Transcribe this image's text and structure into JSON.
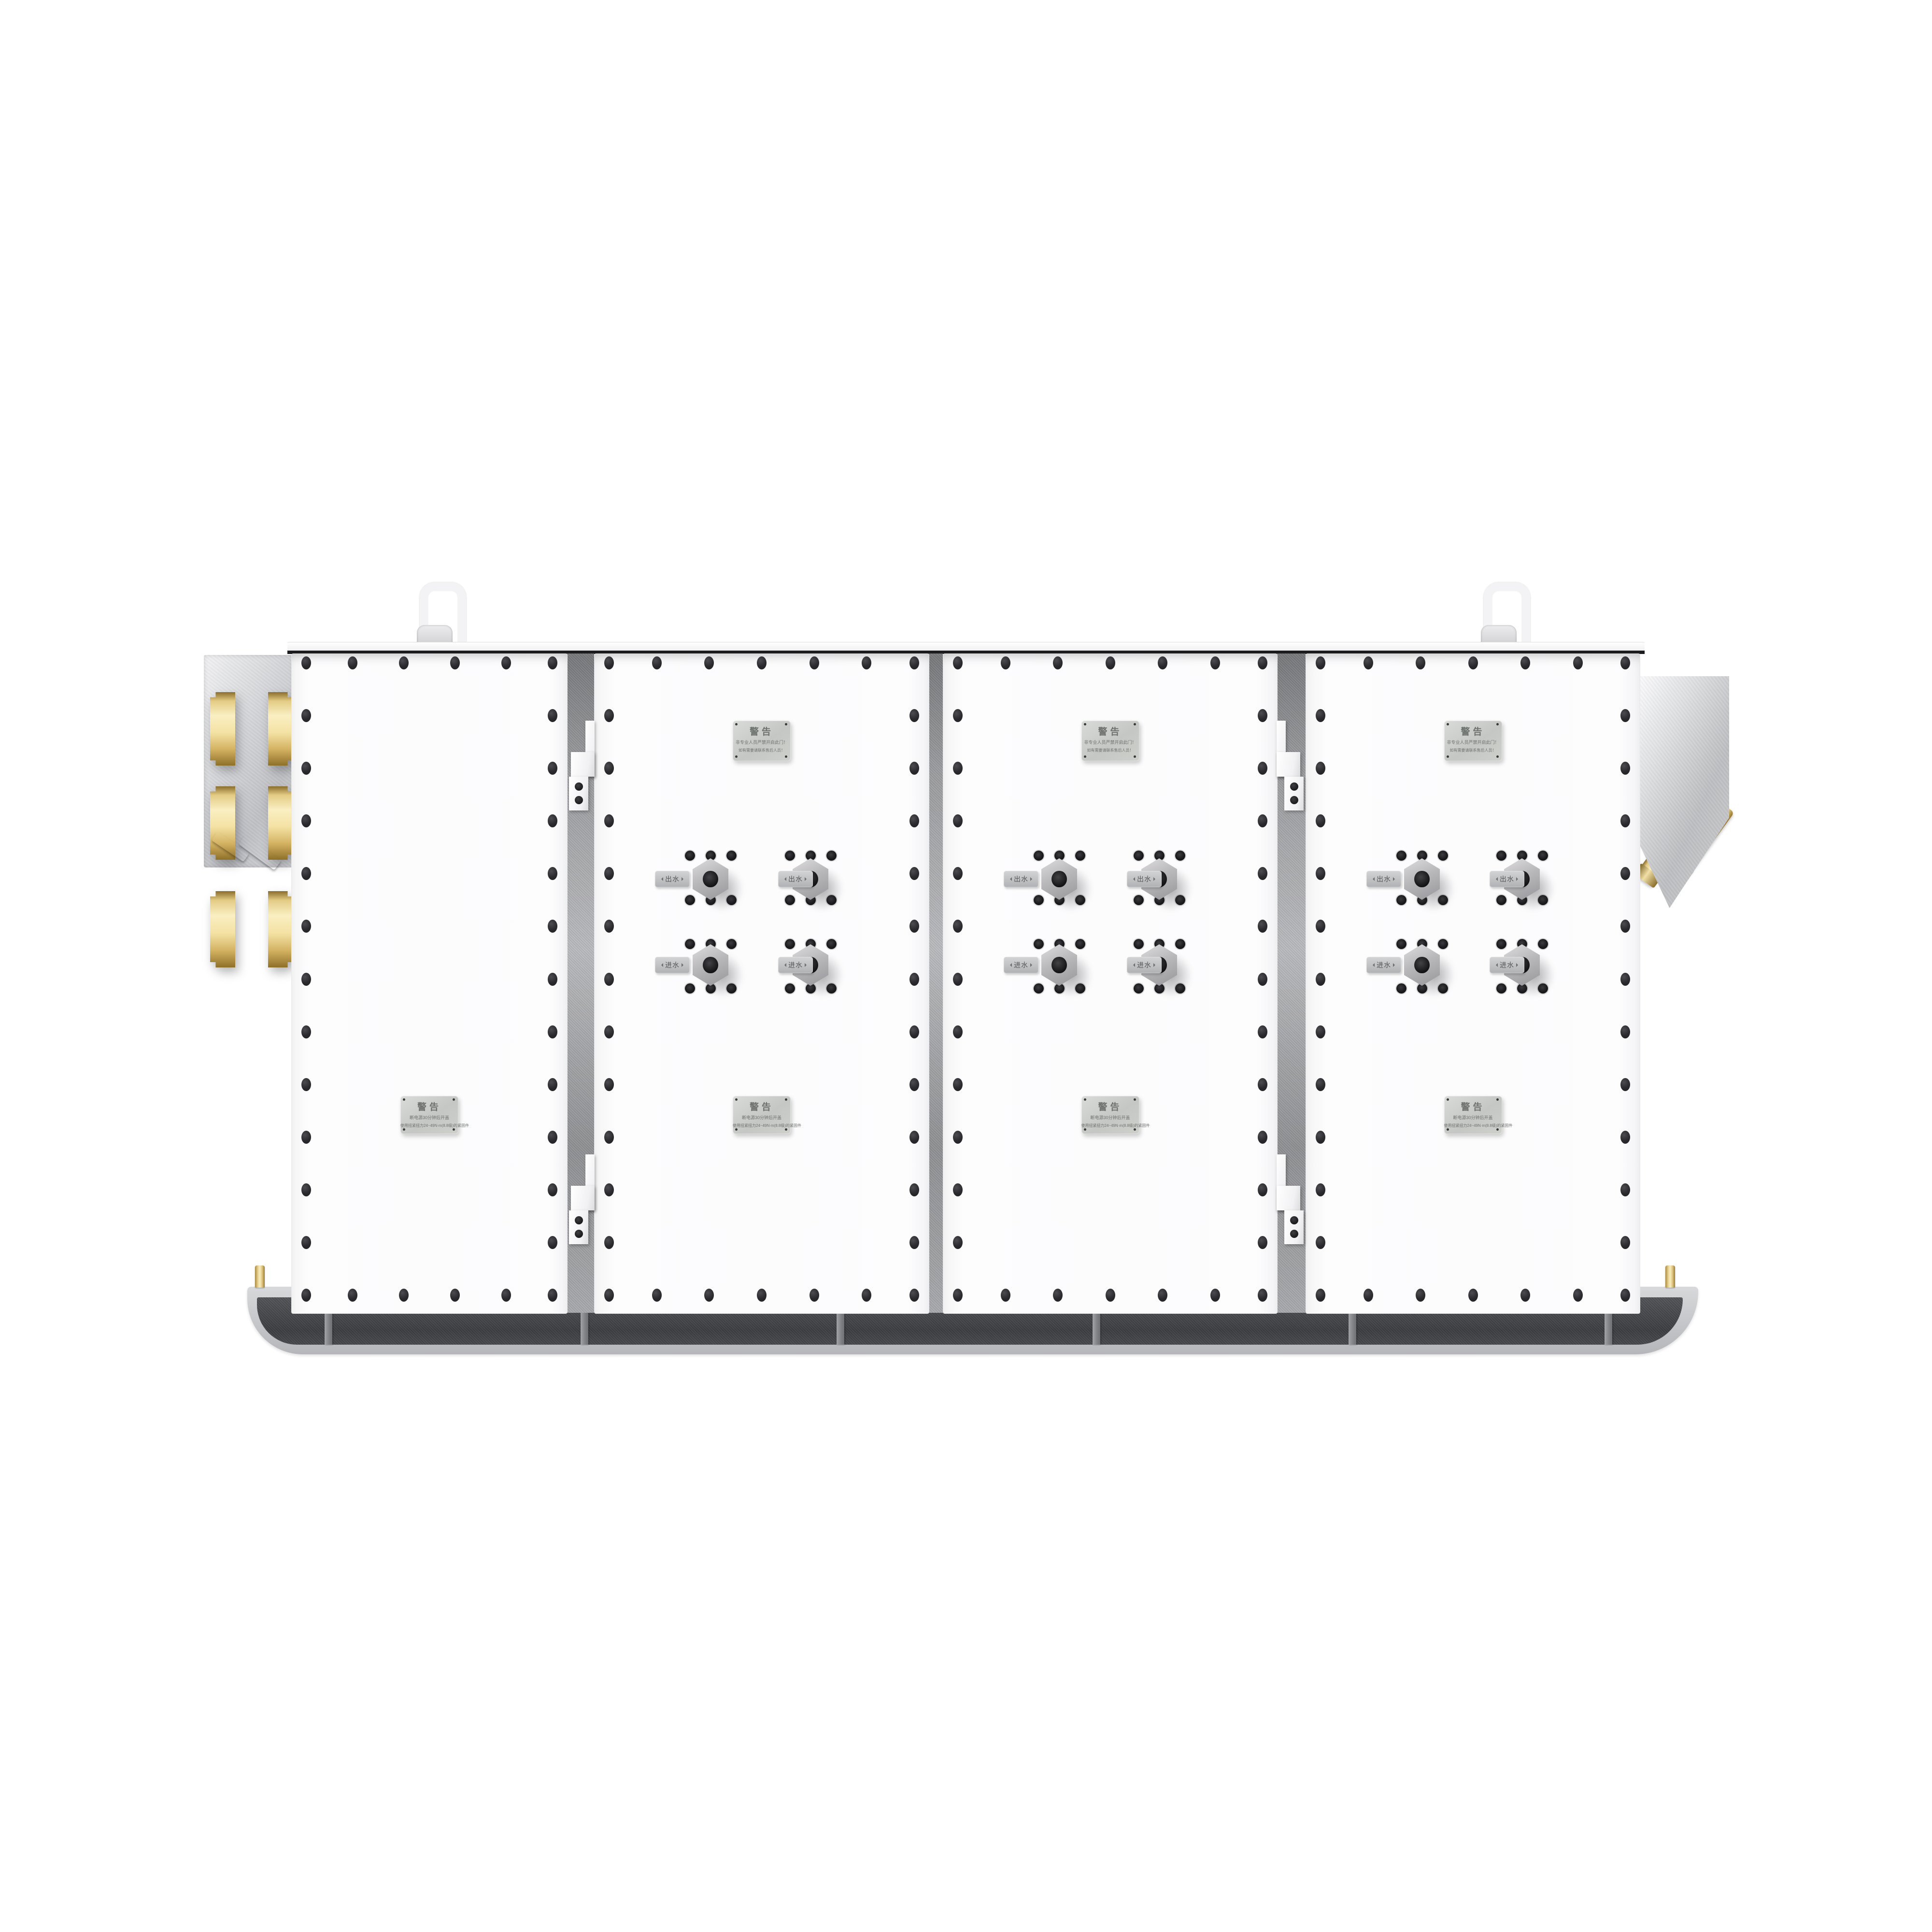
{
  "scene": {
    "kind": "product-render",
    "background": "#ffffff"
  },
  "plates": {
    "top": {
      "title": "警告",
      "lines": [
        "非专业人员严禁开启此门！",
        "如有需要请联系售后人员！"
      ]
    },
    "bottom": {
      "title": "警告",
      "lines": [
        "断电源30分钟后开盖",
        "使用扭紧扭力24~49N·m(8.8级)的紧固件"
      ]
    }
  },
  "port_labels": {
    "outlet": "出水",
    "inlet": "进水"
  },
  "doors": [
    {
      "label": "door-1",
      "top_plate": false,
      "bottom_plate": true,
      "ports": false
    },
    {
      "label": "door-2",
      "top_plate": true,
      "bottom_plate": true,
      "ports": true
    },
    {
      "label": "door-3",
      "top_plate": true,
      "bottom_plate": true,
      "ports": true
    },
    {
      "label": "door-4",
      "top_plate": true,
      "bottom_plate": true,
      "ports": true
    }
  ],
  "colors": {
    "door": "#fcfcfd",
    "bolt": "#26262a",
    "gap_metal": "#9b9c9f",
    "plate_silver": "#c8cbc8",
    "brass": "#f0dc9e",
    "base_outer": "#c9cacc",
    "base_inner": "#47484b",
    "side_panel": "#c4c5c8"
  }
}
